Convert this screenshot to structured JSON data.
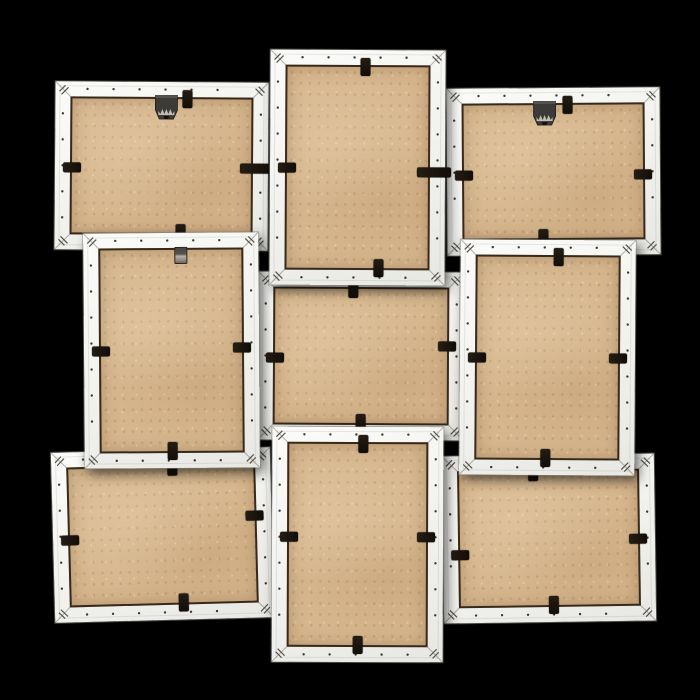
{
  "scene": {
    "description": "Back view of a white wooden 9-photo collage frame photographed on a black background: 3x3 grid of alternating landscape and portrait frames, each showing a tan MDF backing board held by black rotating retainer clips, with mitred corners, staple marks, small nail dots along the rails, and metal sawtooth hangers on the upper frames.",
    "background_color": "#000000",
    "palette": {
      "frame_white_light": "#fbfbf9",
      "frame_white_dark": "#e7e7e3",
      "frame_outline": "#7d7d76",
      "board_tan": "#d6b68d",
      "board_speckle_dark": "#7a5630",
      "board_speckle_light": "#f8ecd4",
      "seam_brown": "#261a0e",
      "clip_black": "#17120c",
      "hanger_plate": "#3d3b38",
      "hanger_metal": "#c2bdb2",
      "dot_color": "#1e160c"
    },
    "rail_width": 15,
    "clip_size": {
      "across": 10,
      "along": 18,
      "wide_along": 34
    },
    "dot_style": {
      "margin": 32,
      "spacing": 26,
      "radius": 1.2
    },
    "frames": [
      {
        "name": "top-left",
        "orientation": "landscape",
        "x": 55,
        "y": 82,
        "w": 213,
        "h": 168,
        "z": 2,
        "rotate": 0.4,
        "hanger": {
          "type": "sawtooth",
          "pos": 0.52
        },
        "clips": [
          {
            "side": "top",
            "pos": 0.62
          },
          {
            "side": "left",
            "pos": 0.51
          },
          {
            "side": "right",
            "pos": 0.51,
            "wide": true
          },
          {
            "side": "bottom",
            "pos": 0.59
          }
        ]
      },
      {
        "name": "top-center",
        "orientation": "portrait",
        "x": 270,
        "y": 50,
        "w": 175,
        "h": 235,
        "z": 4,
        "rotate": 0.3,
        "hanger": null,
        "clips": [
          {
            "side": "top",
            "pos": 0.54
          },
          {
            "side": "left",
            "pos": 0.5
          },
          {
            "side": "right",
            "pos": 0.52,
            "wide": true
          },
          {
            "side": "bottom",
            "pos": 0.62
          }
        ]
      },
      {
        "name": "top-right",
        "orientation": "landscape",
        "x": 447,
        "y": 88,
        "w": 213,
        "h": 167,
        "z": 2,
        "rotate": -0.4,
        "hanger": {
          "type": "sawtooth",
          "pos": 0.46
        },
        "clips": [
          {
            "side": "top",
            "pos": 0.57
          },
          {
            "side": "left",
            "pos": 0.52
          },
          {
            "side": "right",
            "pos": 0.52
          },
          {
            "side": "bottom",
            "pos": 0.45
          }
        ]
      },
      {
        "name": "middle-left",
        "orientation": "portrait",
        "x": 84,
        "y": 233,
        "w": 175,
        "h": 235,
        "z": 3,
        "rotate": -0.4,
        "hanger": {
          "type": "tab",
          "pos": 0.55
        },
        "clips": [
          {
            "side": "left",
            "pos": 0.5
          },
          {
            "side": "right",
            "pos": 0.49
          },
          {
            "side": "bottom",
            "pos": 0.5
          }
        ]
      },
      {
        "name": "center",
        "orientation": "landscape",
        "x": 258,
        "y": 272,
        "w": 206,
        "h": 168,
        "z": 1,
        "rotate": 0.3,
        "hanger": null,
        "clips": [
          {
            "side": "top",
            "pos": 0.46
          },
          {
            "side": "left",
            "pos": 0.51
          },
          {
            "side": "right",
            "pos": 0.44
          },
          {
            "side": "bottom",
            "pos": 0.5
          }
        ]
      },
      {
        "name": "middle-right",
        "orientation": "portrait",
        "x": 460,
        "y": 240,
        "w": 175,
        "h": 235,
        "z": 3,
        "rotate": 0.4,
        "hanger": null,
        "clips": [
          {
            "side": "top",
            "pos": 0.56
          },
          {
            "side": "left",
            "pos": 0.5
          },
          {
            "side": "right",
            "pos": 0.5
          },
          {
            "side": "bottom",
            "pos": 0.49
          }
        ]
      },
      {
        "name": "bottom-left",
        "orientation": "landscape",
        "x": 53,
        "y": 450,
        "w": 219,
        "h": 170,
        "z": 2,
        "rotate": -1.5,
        "hanger": null,
        "clips": [
          {
            "side": "top",
            "pos": 0.55
          },
          {
            "side": "left",
            "pos": 0.52
          },
          {
            "side": "right",
            "pos": 0.4
          },
          {
            "side": "bottom",
            "pos": 0.59
          }
        ]
      },
      {
        "name": "bottom-center",
        "orientation": "portrait",
        "x": 272,
        "y": 427,
        "w": 171,
        "h": 235,
        "z": 4,
        "rotate": 0.2,
        "hanger": null,
        "clips": [
          {
            "side": "top",
            "pos": 0.53
          },
          {
            "side": "left",
            "pos": 0.47
          },
          {
            "side": "right",
            "pos": 0.47
          },
          {
            "side": "bottom",
            "pos": 0.5
          }
        ]
      },
      {
        "name": "bottom-right",
        "orientation": "landscape",
        "x": 443,
        "y": 455,
        "w": 212,
        "h": 167,
        "z": 2,
        "rotate": -0.8,
        "hanger": null,
        "clips": [
          {
            "side": "top",
            "pos": 0.43
          },
          {
            "side": "left",
            "pos": 0.59
          },
          {
            "side": "right",
            "pos": 0.51
          },
          {
            "side": "bottom",
            "pos": 0.52
          }
        ]
      }
    ]
  }
}
